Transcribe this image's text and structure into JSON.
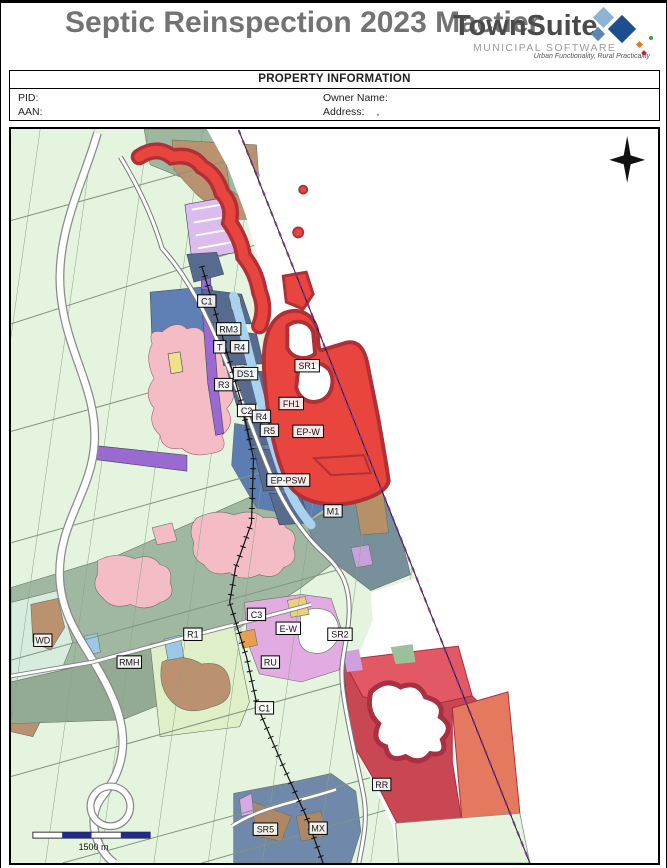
{
  "header": {
    "title": "Septic Reinspection 2023 Mactier",
    "logo": {
      "name": "TownSuite",
      "registered_mark": "®",
      "subtitle": "MUNICIPAL SOFTWARE",
      "tagline": "Urban Functionality, Rural Practicality",
      "colors": {
        "diamond_light": "#8fb3d4",
        "diamond_dark": "#1d4f8f",
        "diamond_mid": "#5a85b5",
        "dot_orange": "#e07820",
        "dot_green": "#4a9a3a",
        "dot_red": "#cc2222"
      }
    }
  },
  "property_info": {
    "title": "PROPERTY INFORMATION",
    "fields": [
      {
        "label": "PID:",
        "value": ""
      },
      {
        "label": "Owner Name:",
        "value": ""
      },
      {
        "label": "AAN:",
        "value": ""
      },
      {
        "label": "Address:",
        "value": ","
      }
    ]
  },
  "map": {
    "north_arrow_icon": "four-point-compass-star",
    "scale_bar": {
      "label": "1500 m"
    },
    "zone_labels": [
      {
        "text": "C1",
        "x": 205,
        "y": 297
      },
      {
        "text": "RM3",
        "x": 227,
        "y": 325
      },
      {
        "text": "T",
        "x": 218,
        "y": 343
      },
      {
        "text": "R4",
        "x": 238,
        "y": 343
      },
      {
        "text": "DS1",
        "x": 244,
        "y": 370
      },
      {
        "text": "R3",
        "x": 222,
        "y": 381
      },
      {
        "text": "C2",
        "x": 245,
        "y": 407
      },
      {
        "text": "R4",
        "x": 260,
        "y": 413
      },
      {
        "text": "R5",
        "x": 268,
        "y": 427
      },
      {
        "text": "SR1",
        "x": 306,
        "y": 362
      },
      {
        "text": "FH1",
        "x": 290,
        "y": 400
      },
      {
        "text": "EP-W",
        "x": 307,
        "y": 428
      },
      {
        "text": "EP-PSW",
        "x": 287,
        "y": 477
      },
      {
        "text": "M1",
        "x": 332,
        "y": 508
      },
      {
        "text": "C3",
        "x": 255,
        "y": 612
      },
      {
        "text": "R1",
        "x": 191,
        "y": 632
      },
      {
        "text": "E-W",
        "x": 287,
        "y": 626
      },
      {
        "text": "SR2",
        "x": 339,
        "y": 632
      },
      {
        "text": "WD",
        "x": 40,
        "y": 638
      },
      {
        "text": "RMH",
        "x": 127,
        "y": 660
      },
      {
        "text": "RU",
        "x": 269,
        "y": 660
      },
      {
        "text": "C1",
        "x": 263,
        "y": 706
      },
      {
        "text": "RR",
        "x": 381,
        "y": 783
      },
      {
        "text": "SR5",
        "x": 264,
        "y": 828
      },
      {
        "text": "MX",
        "x": 317,
        "y": 827
      }
    ],
    "colors": {
      "hazard_red": "#e8453f",
      "hazard_edge_crimson": "#b03038",
      "water_white": "#ffffff",
      "parcel_mint": "#e4f4de",
      "rural_sage": "#a0b8a2",
      "residential_blue": "#5f80b4",
      "village_pink": "#f4bdc6",
      "institutional_purple": "#9a6ad0",
      "orchid_mixed": "#e2abe2",
      "tan_open_space": "#bb9270",
      "lake_blue_gray": "#7088aa",
      "scale_navy": "#20298c"
    }
  }
}
